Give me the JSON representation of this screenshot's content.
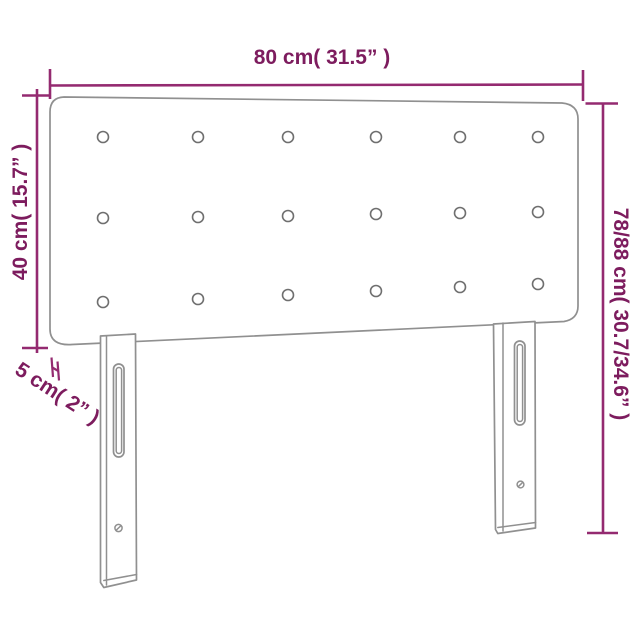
{
  "diagram": {
    "title": "Headboard dimension diagram",
    "product": "upholstered headboard with two slotted legs",
    "colors": {
      "dimension_line": "#942a70",
      "dimension_text": "#7d1c5e",
      "outline": "#909090",
      "button_outline": "#6f6f6f",
      "background": "#ffffff"
    },
    "dimensions": {
      "width": {
        "label": "80 cm( 31.5” )",
        "position": "top"
      },
      "height_left": {
        "label": "40 cm( 15.7” )",
        "position": "left"
      },
      "height_right": {
        "label": "78/88 cm( 30.7/34.6” )",
        "position": "right"
      },
      "depth": {
        "label": "5 cm( 2” )",
        "position": "bottom-left"
      }
    },
    "tufting": {
      "rows": 3,
      "columns": 6,
      "button_count": 18
    }
  }
}
